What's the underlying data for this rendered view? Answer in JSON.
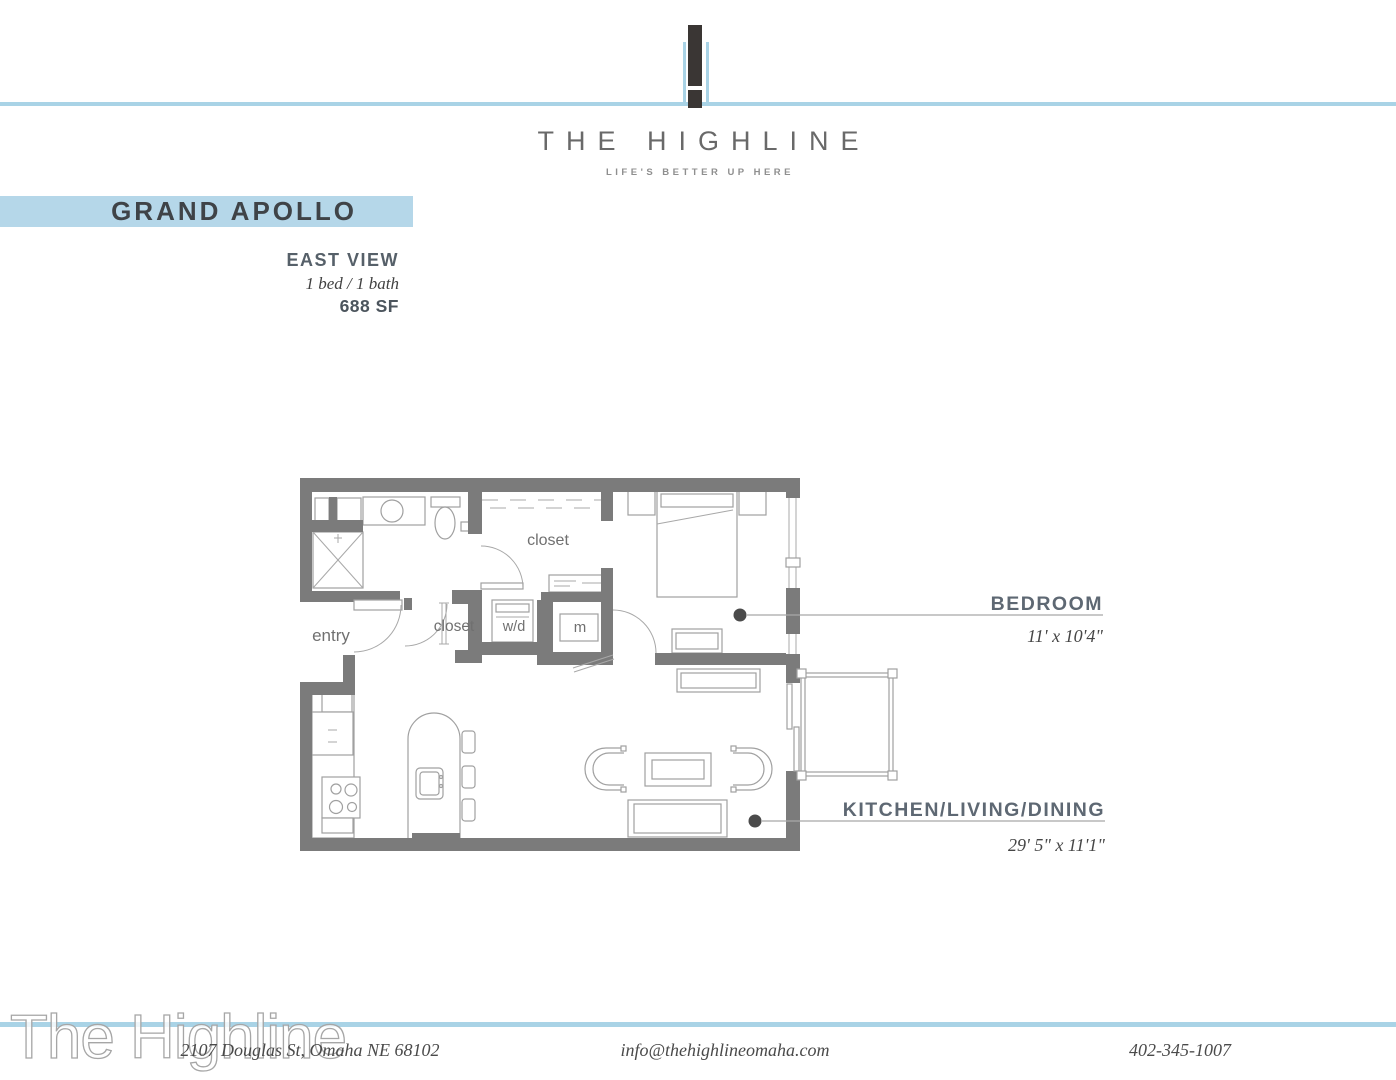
{
  "brand": {
    "name": "THE HIGHLINE",
    "tagline": "LIFE'S BETTER UP HERE"
  },
  "plan": {
    "title": "GRAND APOLLO",
    "view": "EAST VIEW",
    "config": "1 bed / 1 bath",
    "area": "688 SF"
  },
  "floorplan": {
    "labels": {
      "entry": "entry",
      "closet_walk": "closet",
      "closet_hall": "closet",
      "washer_dryer": "w/d",
      "mechanical": "m"
    },
    "rooms": [
      {
        "name": "BEDROOM",
        "dims": "11' x 10'4\""
      },
      {
        "name": "KITCHEN/LIVING/DINING",
        "dims": "29' 5\" x 11'1\""
      }
    ]
  },
  "footer": {
    "address": "2107 Douglas St, Omaha NE 68102",
    "email": "info@thehighlineomaha.com",
    "phone": "402-345-1007",
    "watermark": "The Highline"
  },
  "colors": {
    "accent_blue": "#a9d3e6",
    "banner_blue": "#b5d7e9",
    "wall_gray": "#7b7b7b",
    "label_slate": "#5e6873"
  }
}
